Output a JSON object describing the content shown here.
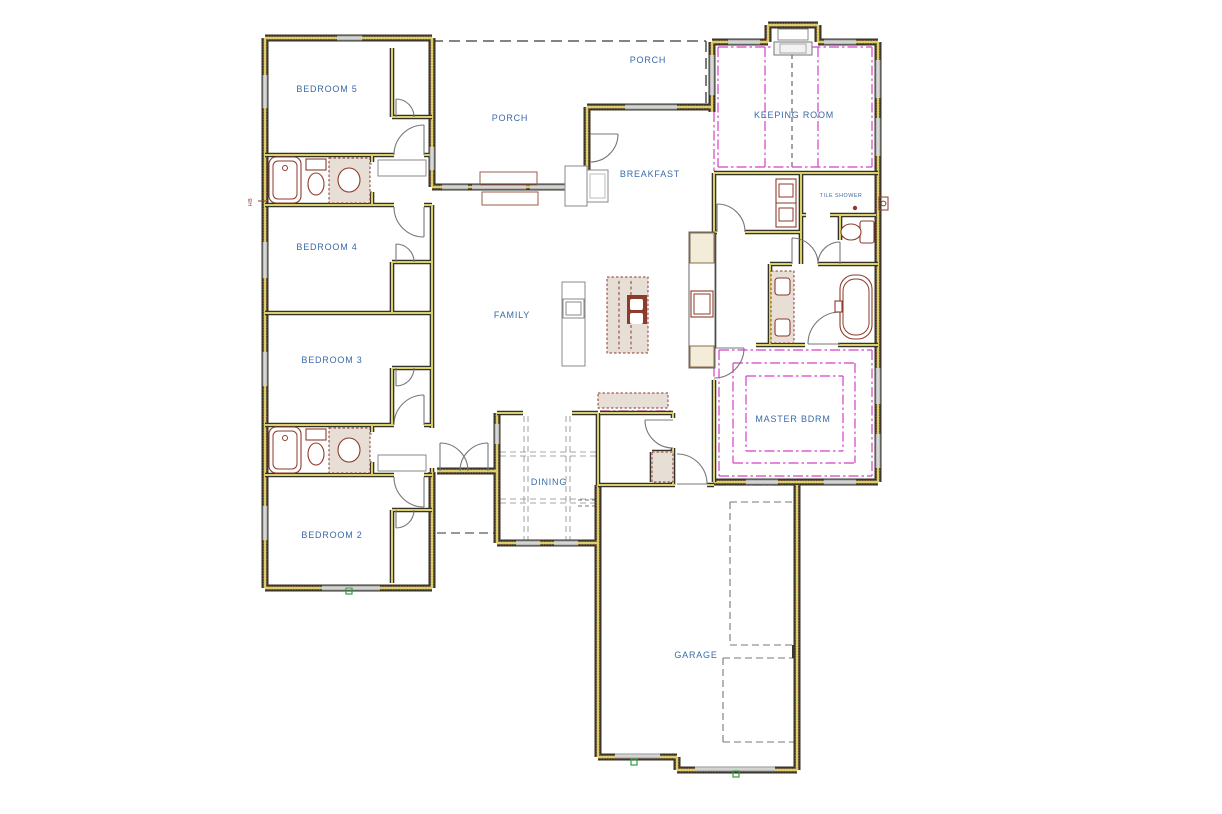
{
  "drawing": {
    "type": "residential-floor-plan",
    "labels": {
      "porch_top": "PORCH",
      "porch_left": "PORCH",
      "keeping_room": "KEEPING ROOM",
      "breakfast": "BREAKFAST",
      "bedroom5": "BEDROOM 5",
      "bedroom4": "BEDROOM 4",
      "bedroom3": "BEDROOM 3",
      "bedroom2": "BEDROOM 2",
      "family": "FAMILY",
      "dining": "DINING",
      "master_bdrm": "MASTER BDRM",
      "garage": "GARAGE",
      "tile_shower": "TILE SHOWER",
      "hose_bib": "HB"
    },
    "colors": {
      "room_label": "#3a6aa8",
      "wall_core": "#33332a",
      "wall_fill": "#d9d06c",
      "brick": "#9c4f38",
      "ceiling_accent": "#d63fc8",
      "fixture": "#8c3b2c",
      "fixture_fill": "#e7ded6",
      "window": "#8f8f8f",
      "door": "#777777",
      "dashed_overhead": "#5a5a5a",
      "marker": "#2f9e3f",
      "cabinet_fill": "#f2ecd8"
    }
  }
}
